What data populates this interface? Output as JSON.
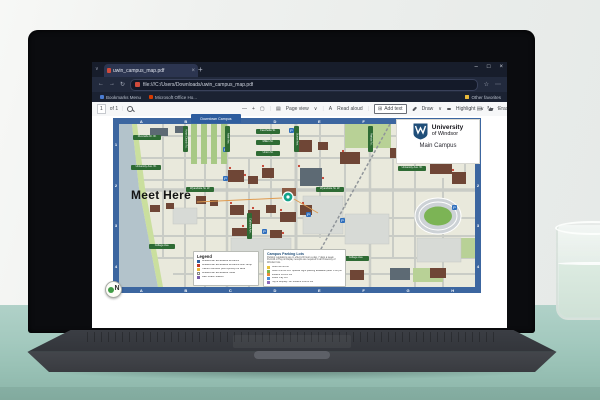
{
  "browser": {
    "tab_title": "uwin_campus_map.pdf",
    "tab_close_icon": "×",
    "new_tab_icon": "+",
    "tab_caret_icon": "∨",
    "window_controls": {
      "minimize": "–",
      "maximize": "□",
      "close": "×"
    },
    "nav": {
      "back_icon": "←",
      "forward_icon": "→",
      "refresh_icon": "↻"
    },
    "url": "file:///C:/Users/Downloads/uwin_campus_map.pdf",
    "address_right": {
      "favorite_icon": "☆",
      "more_icon": "⋯"
    },
    "bookmarks": {
      "item1": "Bookmarks Menu",
      "item2": "Microsoft Office Ho...",
      "other_label": "Other favorites"
    },
    "pdf_toolbar": {
      "page_number": "1",
      "of_label": "of 1",
      "zoom_out_icon": "—",
      "zoom_in_icon": "+",
      "fit_icon": "▢",
      "page_view_icon": "▤",
      "page_view_label": "Page view",
      "read_aloud_icon": "A",
      "read_aloud_label": "Read aloud",
      "add_text_icon": "⊞",
      "add_text_label": "Add text",
      "draw_label": "Draw",
      "highlight_label": "Highlight",
      "erase_label": "Erase",
      "caret_icon": "∨",
      "save_icon": "↓",
      "print_icon": "▤",
      "rotate_icon": "↻",
      "more_icon": "⋯"
    }
  },
  "map": {
    "org_line1": "University",
    "org_line2": "of Windsor",
    "campus_label": "Main Campus",
    "downtown_label": "Downtown Campus",
    "annotation": "Meet Here",
    "compass_letter": "N",
    "parking_icon_letter": "P",
    "grid_letters": [
      "A",
      "B",
      "C",
      "D",
      "E",
      "F",
      "G",
      "H"
    ],
    "grid_numbers": [
      "1",
      "2",
      "3",
      "4"
    ],
    "streets": [
      {
        "name": "Riverside Dr. W.",
        "x": 20,
        "y": 17,
        "w": 28,
        "h": 5,
        "o": "h"
      },
      {
        "name": "University Ave. W.",
        "x": 18,
        "y": 47,
        "w": 30,
        "h": 5,
        "o": "h"
      },
      {
        "name": "Wyandotte St. W.",
        "x": 73,
        "y": 69,
        "w": 28,
        "h": 5,
        "o": "h"
      },
      {
        "name": "College Ave.",
        "x": 36,
        "y": 126,
        "w": 26,
        "h": 5,
        "o": "h"
      },
      {
        "name": "Fanchette St.",
        "x": 143,
        "y": 11,
        "w": 24,
        "h": 5,
        "o": "h"
      },
      {
        "name": "Millen St.",
        "x": 143,
        "y": 22,
        "w": 24,
        "h": 5,
        "o": "h"
      },
      {
        "name": "Union St.",
        "x": 143,
        "y": 33,
        "w": 24,
        "h": 5,
        "o": "h"
      },
      {
        "name": "Wyandotte St. W.",
        "x": 203,
        "y": 69,
        "w": 28,
        "h": 5,
        "o": "h"
      },
      {
        "name": "Riverside Dr. W.",
        "x": 285,
        "y": 32,
        "w": 28,
        "h": 5,
        "o": "h"
      },
      {
        "name": "University Ave. W.",
        "x": 285,
        "y": 48,
        "w": 28,
        "h": 5,
        "o": "h"
      },
      {
        "name": "College Ave.",
        "x": 230,
        "y": 138,
        "w": 26,
        "h": 5,
        "o": "h"
      },
      {
        "name": "Huron Church Rd.",
        "x": 70,
        "y": 8,
        "w": 5,
        "h": 26,
        "o": "v"
      },
      {
        "name": "Askin Ave.",
        "x": 112,
        "y": 8,
        "w": 5,
        "h": 26,
        "o": "v"
      },
      {
        "name": "Sunset Ave.",
        "x": 181,
        "y": 8,
        "w": 5,
        "h": 26,
        "o": "v"
      },
      {
        "name": "Patricia Rd.",
        "x": 255,
        "y": 8,
        "w": 5,
        "h": 26,
        "o": "v"
      },
      {
        "name": "California Ave.",
        "x": 134,
        "y": 95,
        "w": 5,
        "h": 26,
        "o": "v"
      }
    ],
    "p_markers": [
      [
        110,
        29
      ],
      [
        176,
        10
      ],
      [
        110,
        58
      ],
      [
        193,
        94
      ],
      [
        306,
        10
      ],
      [
        149,
        111
      ],
      [
        339,
        87
      ],
      [
        227,
        100
      ]
    ],
    "legend": {
      "title": "Legend",
      "items": [
        {
          "color": "#2e5fa3",
          "label": "Wheelchair accessible entrance"
        },
        {
          "color": "#c0392b",
          "label": "Wheelchair accessible entrance with ramp"
        },
        {
          "color": "#e8b93a",
          "label": "Transit Windsor pick up/drop off area"
        },
        {
          "color": "#ffffff",
          "label": "Wheelchair accessible route"
        },
        {
          "color": "#7a5ca8",
          "label": "Bike Share Station"
        }
      ]
    },
    "parking": {
      "title": "Campus Parking Lots",
      "note": "Parking regulations are in effect 24 hours a day, 7 days a week. Permits or Pay & Display receipts are required in all University of Windsor lots.",
      "lots": [
        {
          "color": "#e8c23a",
          "label": "Gold Permit Lot"
        },
        {
          "color": "#7ab648",
          "label": "Green Permit Lot. Special night parking available (after 5:00 pm)"
        },
        {
          "color": "#e98b3a",
          "label": "Student Permit Lot"
        },
        {
          "color": "#4a90d9",
          "label": "Visitor Pay Lot"
        },
        {
          "color": "#8e6ab8",
          "label": "Pay & Display / All Student Permit Lot"
        }
      ]
    },
    "colors": {
      "frame": "#3c66a0",
      "water": "#b3c3cb",
      "building": "#6f4636",
      "building_alt": "#5d6a74",
      "park": "#b8d196",
      "road": "#c9ccc6",
      "block": "#e9e9dc",
      "street_bar": "#2e6b34",
      "marker": "#14a38b",
      "leader": "#df9a4e",
      "parking_icon": "#2f6fbd"
    }
  }
}
